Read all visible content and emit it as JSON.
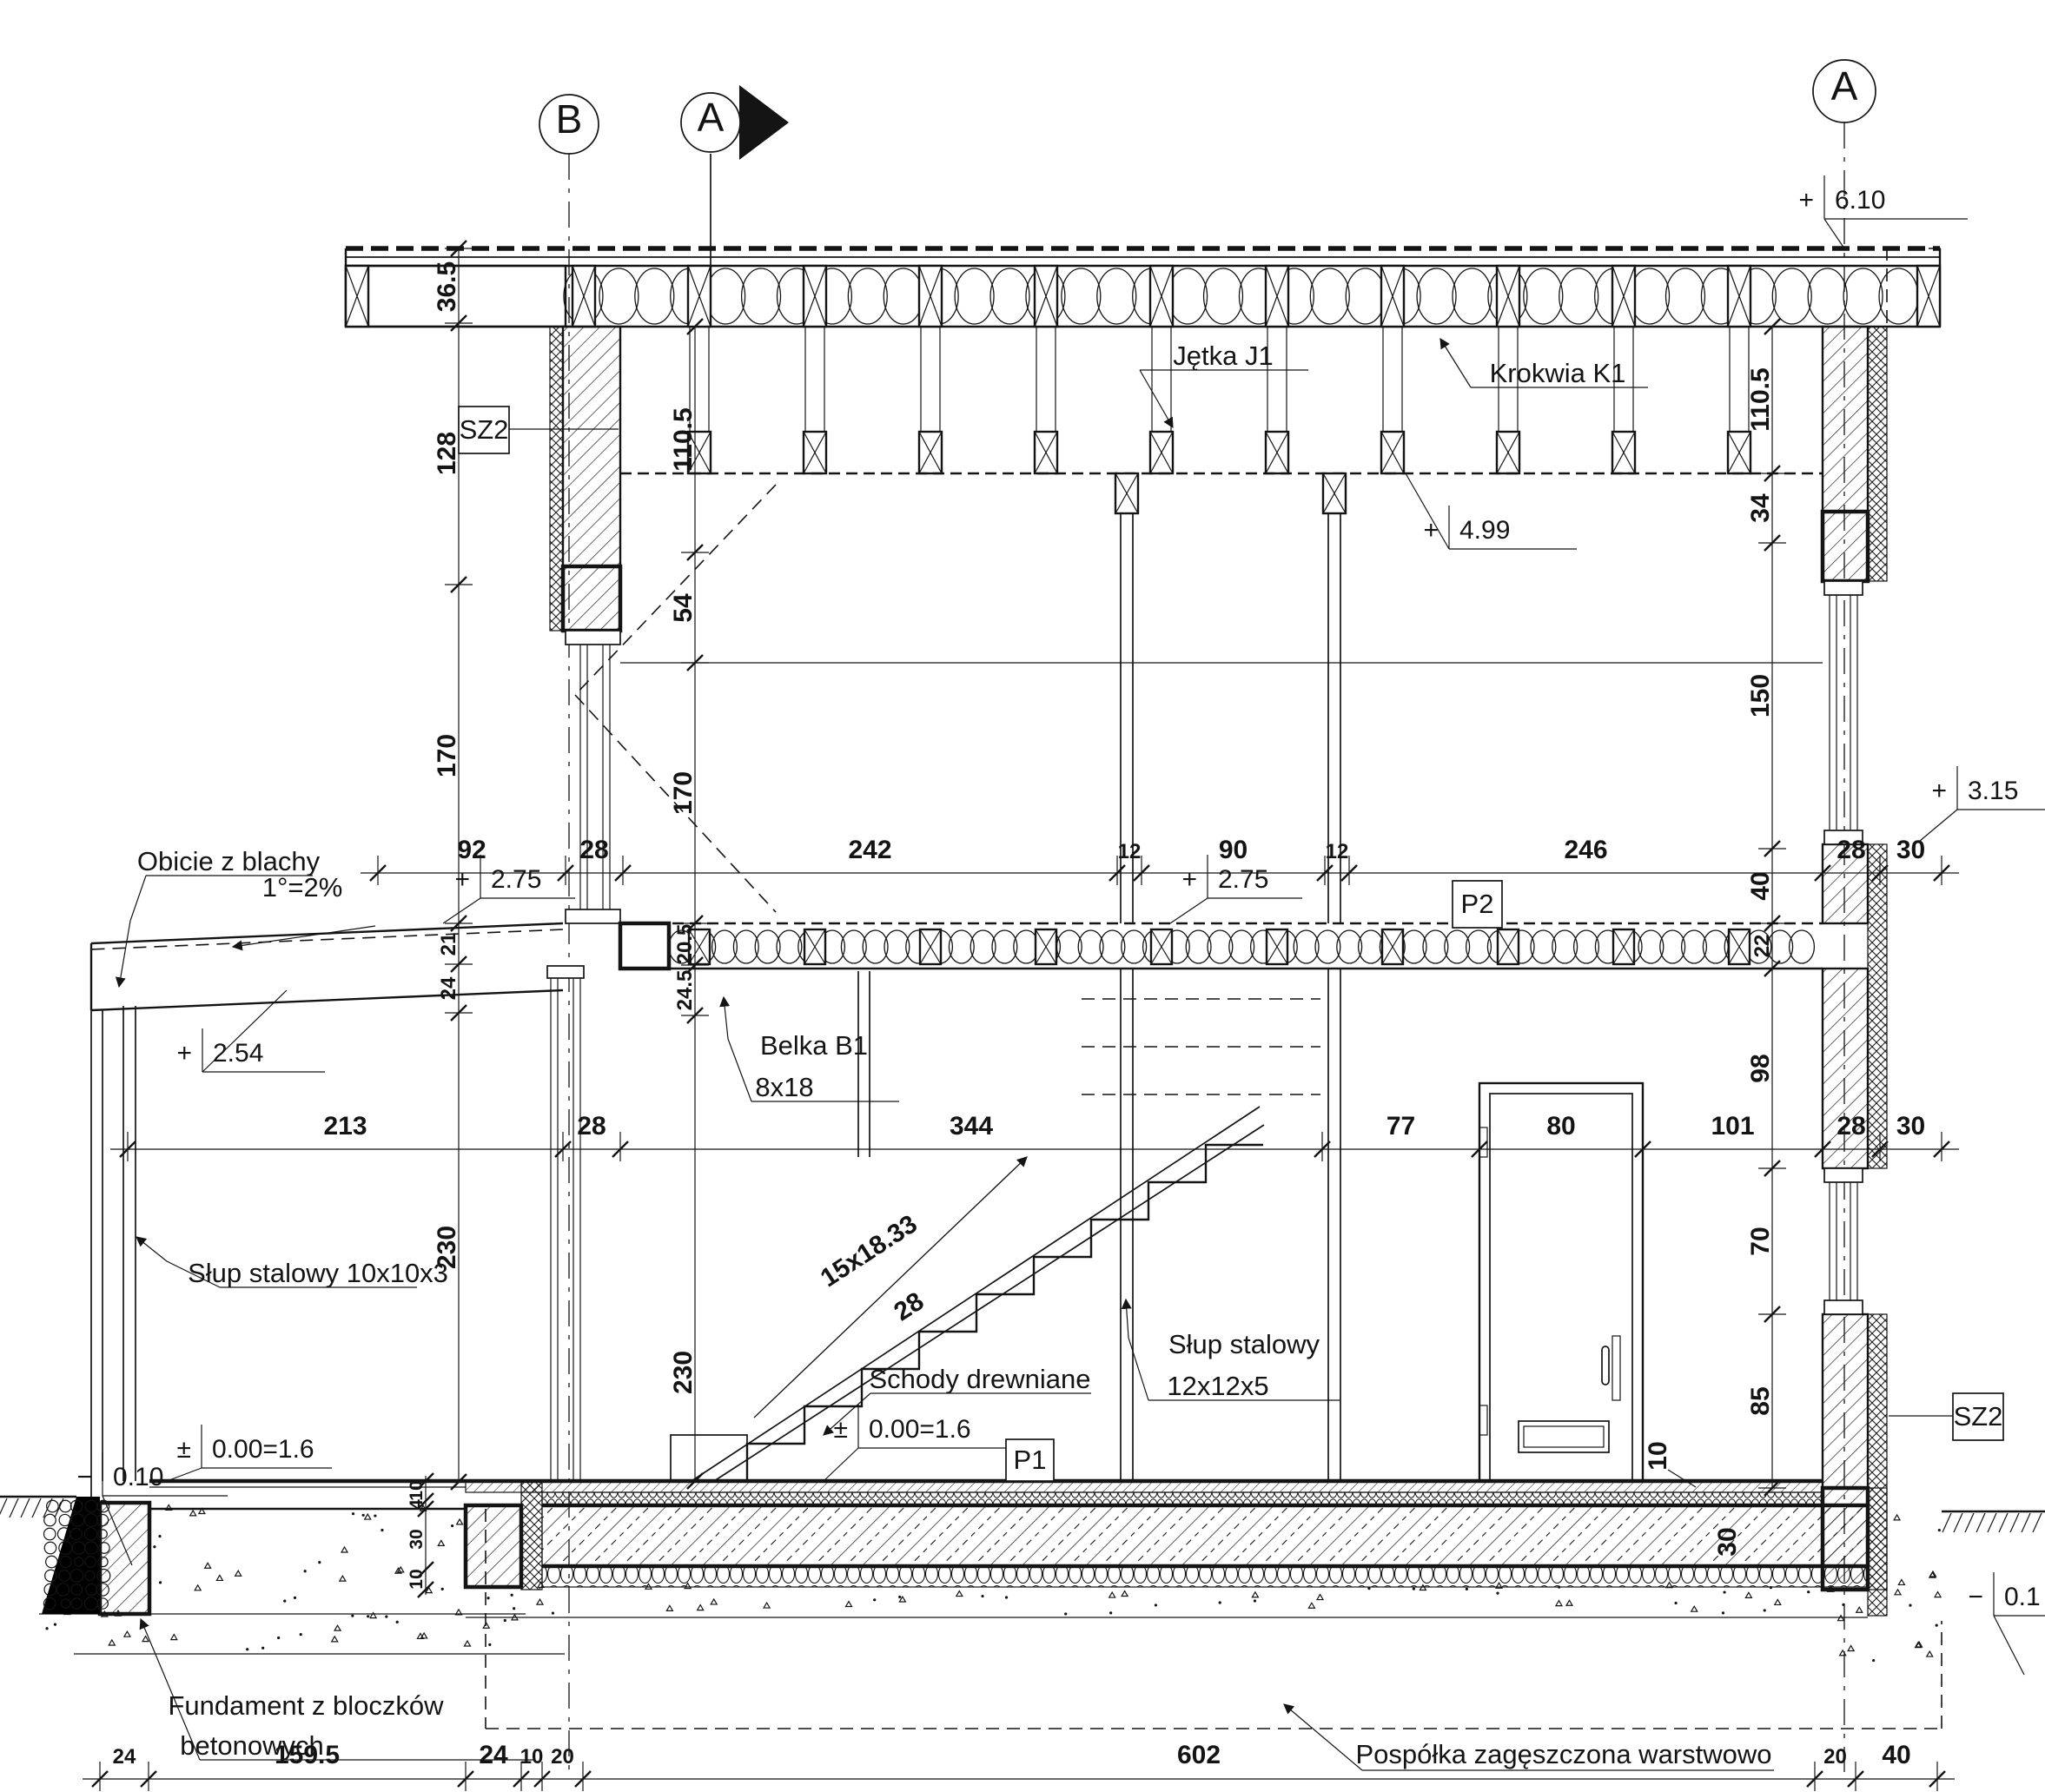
{
  "drawing": {
    "grid": [
      {
        "letter": "B"
      },
      {
        "letter": "A"
      },
      {
        "letter": "A"
      }
    ],
    "levels": [
      {
        "sign": "+",
        "value": "6.10"
      },
      {
        "sign": "+",
        "value": "4.99"
      },
      {
        "sign": "+",
        "value": "3.15"
      },
      {
        "sign": "+",
        "value": "2.75"
      },
      {
        "sign": "+",
        "value": "2.75"
      },
      {
        "sign": "+",
        "value": "2.54"
      },
      {
        "sign": "±",
        "value": "0.00=1.6"
      },
      {
        "sign": "±",
        "value": "0.00=1.6"
      },
      {
        "sign": "−",
        "value": "0.10"
      },
      {
        "sign": "−",
        "value": "0.1"
      }
    ],
    "dim_rows": [
      {
        "values": [
          "92",
          "28",
          "242",
          "12",
          "90",
          "12",
          "246",
          "28",
          "30"
        ]
      },
      {
        "values": [
          "213",
          "28",
          "344",
          "77",
          "80",
          "101",
          "28",
          "30"
        ]
      },
      {
        "values": [
          "24",
          "159.5",
          "24",
          "10",
          "20",
          "602",
          "20",
          "40"
        ]
      }
    ],
    "v_chains": [
      {
        "values": [
          "36.5",
          "128",
          "170",
          "21",
          "24",
          "230"
        ]
      },
      {
        "values": [
          "110.5",
          "54",
          "170",
          "20.5",
          "24.5",
          "230"
        ]
      },
      {
        "values": [
          "110.5",
          "34",
          "150",
          "40",
          "22",
          "98",
          "70",
          "85"
        ]
      }
    ],
    "slab_layers": {
      "values": [
        "10",
        "4",
        "30",
        "10"
      ]
    },
    "slab_width": "30",
    "floor_layer_10": "10",
    "stair_formula": {
      "line1": "15x18.33",
      "line2": "28"
    },
    "boxes": {
      "sz2_left": "SZ2",
      "sz2_right": "SZ2",
      "p1": "P1",
      "p2": "P2"
    },
    "notes": {
      "obicie": "Obicie z blachy",
      "slope": "1°=2%",
      "jetka": "Jętka J1",
      "krokwia": "Krokwia K1",
      "belka1": "Belka B1",
      "belka2": "8x18",
      "slup12a": "Słup stalowy",
      "slup12b": "12x12x5",
      "slup10": "Słup stalowy 10x10x3",
      "schody": "Schody drewniane",
      "fundament1": "Fundament z bloczków",
      "fundament2": "betonowych",
      "pospolka": "Pospółka zagęszczona warstwowo"
    }
  }
}
